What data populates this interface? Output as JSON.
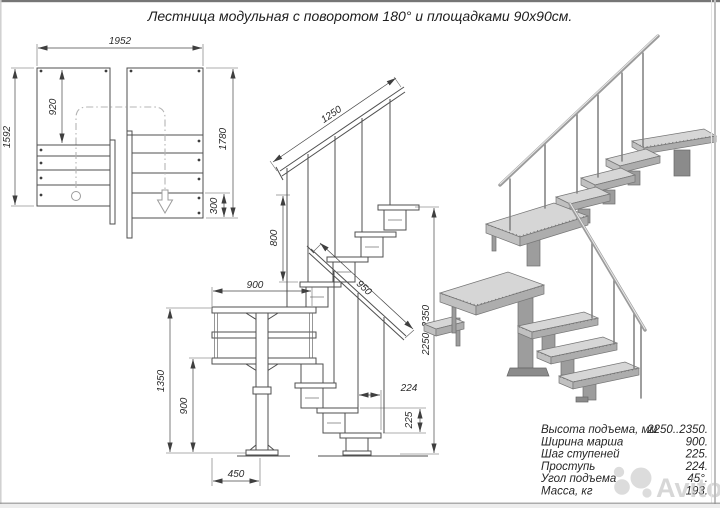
{
  "title": "Лестница модульная с поворотом 180° и площадками 90х90см.",
  "plan": {
    "width": "1952",
    "depth": "1592",
    "platform_depth": "920",
    "right_depth": "1780",
    "last_step": "300"
  },
  "elevation": {
    "upper_rail": "1250",
    "rail_height": "800",
    "march_width": "900",
    "lower_rail": "950",
    "total_rise": "2250..2350",
    "tread": "224",
    "riser": "225",
    "upper_platform": "1350",
    "lower_platform": "900",
    "base_offset": "450"
  },
  "specs": {
    "rows": [
      {
        "label": "Высота подъема, мм",
        "value": "2250..2350."
      },
      {
        "label": "Ширина марша",
        "value": "900."
      },
      {
        "label": "Шаг ступеней",
        "value": "225."
      },
      {
        "label": "Проступь",
        "value": "224."
      },
      {
        "label": "Угол подъема",
        "value": "45°."
      },
      {
        "label": "Масса, кг",
        "value": "193."
      }
    ]
  },
  "watermark": {
    "brand": "Avito"
  },
  "colors": {
    "line": "#4f4f4f",
    "dim_text": "#2b2b2b",
    "render_light": "#d6d6d6",
    "render_mid": "#c0c0c0",
    "render_dark": "#9d9d9d",
    "watermark": "#bdbdbd"
  }
}
